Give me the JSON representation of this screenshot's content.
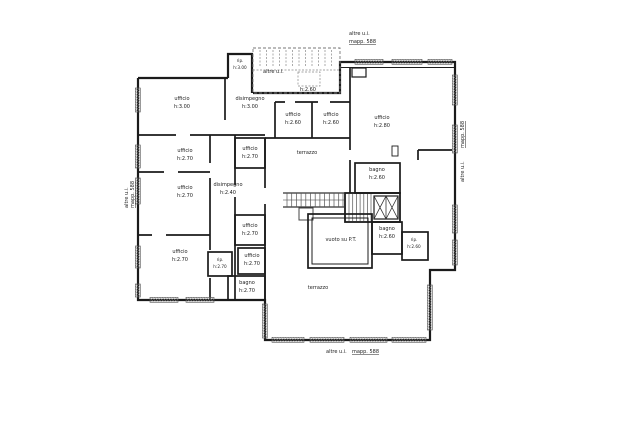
{
  "plan": {
    "colors": {
      "wall": "#1b1b1b",
      "thin": "#555555",
      "dashed": "#777777",
      "text": "#1c1c1c",
      "background": "#ffffff"
    },
    "annotations": {
      "top_right_line1": "altre u.i.",
      "top_right_line2": "mapp. 588",
      "other_unit_stair": "altre u.i.",
      "corridor_height": "h:2.60",
      "left_side_line1": "altre u.i.",
      "left_side_line2": "mapp. 588",
      "right_side_line1": "mapp. 588",
      "right_side_line2": "altre u.i.",
      "bottom_line1": "altre u.i.",
      "bottom_line2": "mapp. 588"
    },
    "rooms": [
      {
        "name": "rip.",
        "height": "h:3.00"
      },
      {
        "name": "ufficio",
        "height": "h:3.00"
      },
      {
        "name": "disimpegno",
        "height": "h:3.00"
      },
      {
        "name": "ufficio",
        "height": "h:2.60"
      },
      {
        "name": "ufficio",
        "height": "h:2.60"
      },
      {
        "name": "ufficio",
        "height": "h:2.80"
      },
      {
        "name": "terrazzo",
        "height": ""
      },
      {
        "name": "ufficio",
        "height": "h:2.70"
      },
      {
        "name": "ufficio",
        "height": "h:2.70"
      },
      {
        "name": "ufficio",
        "height": "h:2.70"
      },
      {
        "name": "disimpegno",
        "height": "h:2.40"
      },
      {
        "name": "bagno",
        "height": "h:2.60"
      },
      {
        "name": "ufficio",
        "height": "h:2.70"
      },
      {
        "name": "ufficio",
        "height": "h:2.70"
      },
      {
        "name": "rip.",
        "height": "h:2.70"
      },
      {
        "name": "ufficio",
        "height": "h:2.70"
      },
      {
        "name": "bagno",
        "height": "h:2.70"
      },
      {
        "name": "vuoto su P.T.",
        "height": ""
      },
      {
        "name": "bagno",
        "height": "h:2.60"
      },
      {
        "name": "rip.",
        "height": "h:2.60"
      },
      {
        "name": "terrazzo",
        "height": ""
      }
    ]
  }
}
